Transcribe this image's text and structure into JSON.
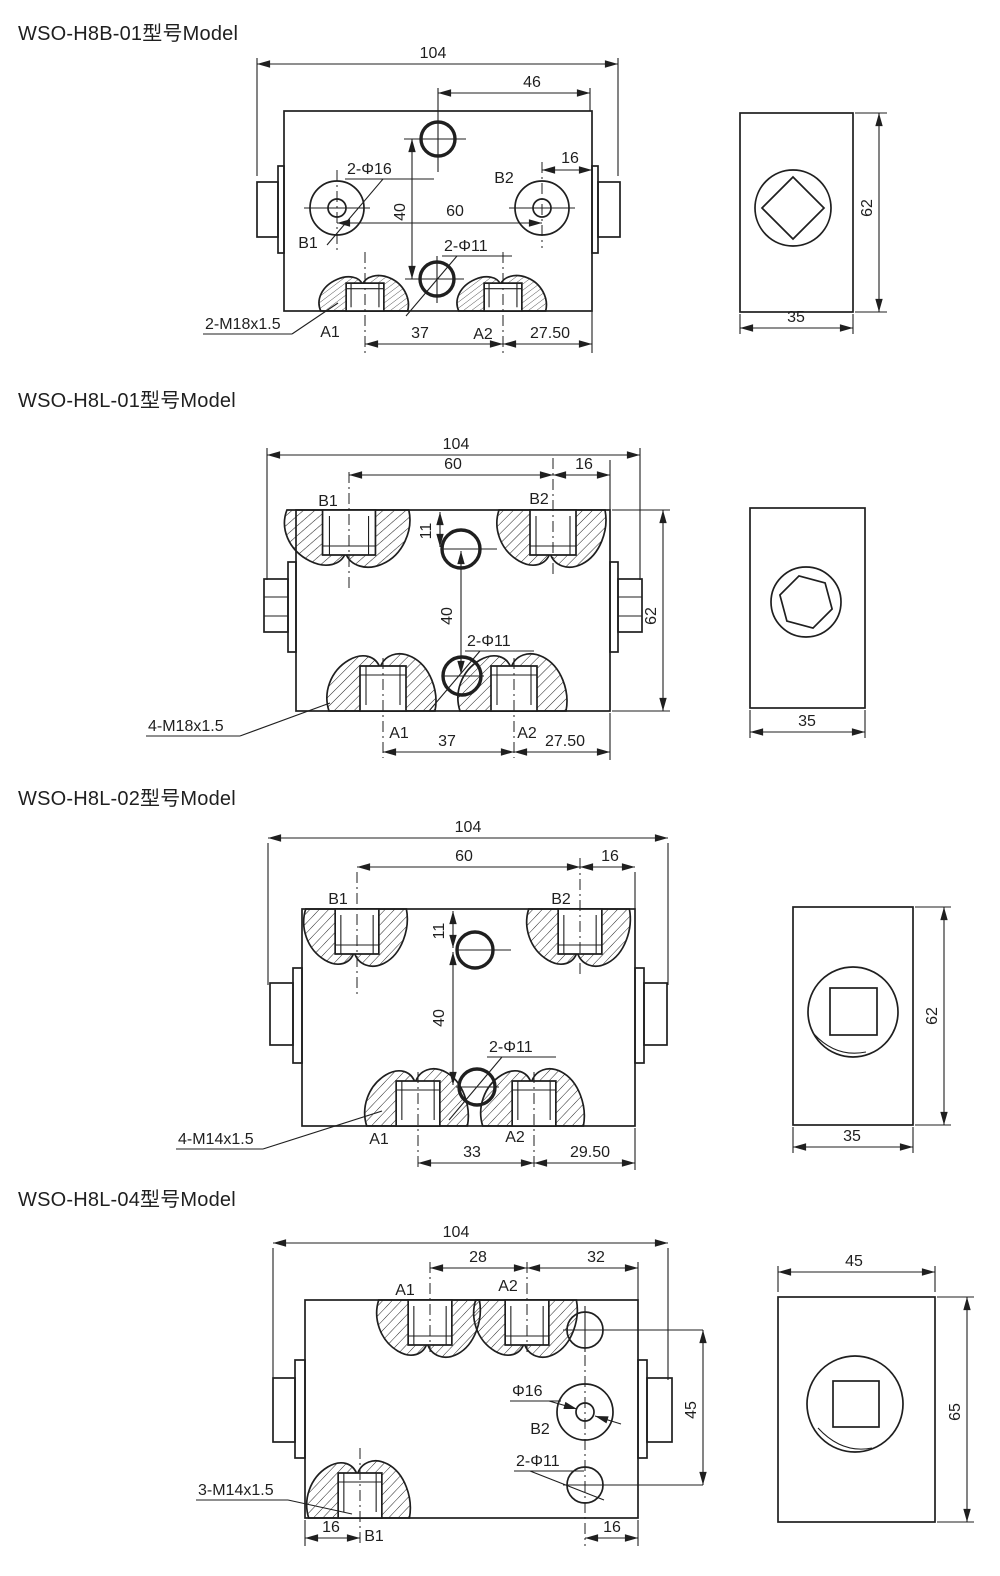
{
  "drawing": {
    "line_color": "#1f1f1f",
    "sections": [
      {
        "title": "WSO-H8B-01型号Model",
        "front": {
          "labels": {
            "b1": "B1",
            "b2": "B2",
            "a1": "A1",
            "a2": "A2"
          },
          "dims": {
            "overall_width": "104",
            "top_hole_from_edge": "46",
            "b2_to_edge": "16",
            "port_spacing": "60",
            "hole_vertical": "40",
            "a_spacing": "37",
            "a2_to_edge": "27.50"
          },
          "callouts": {
            "phi16": "2-Φ16",
            "phi11": "2-Φ11",
            "thread": "2-M18x1.5"
          }
        },
        "side": {
          "dims": {
            "height": "62",
            "depth": "35"
          }
        }
      },
      {
        "title": "WSO-H8L-01型号Model",
        "front": {
          "labels": {
            "b1": "B1",
            "b2": "B2",
            "a1": "A1",
            "a2": "A2"
          },
          "dims": {
            "overall_width": "104",
            "port_spacing": "60",
            "b2_to_edge": "16",
            "hole_offset": "11",
            "hole_vertical": "40",
            "height": "62",
            "a_spacing": "37",
            "a2_to_edge": "27.50"
          },
          "callouts": {
            "phi11": "2-Φ11",
            "thread": "4-M18x1.5"
          }
        },
        "side": {
          "dims": {
            "depth": "35"
          }
        }
      },
      {
        "title": "WSO-H8L-02型号Model",
        "front": {
          "labels": {
            "b1": "B1",
            "b2": "B2",
            "a1": "A1",
            "a2": "A2"
          },
          "dims": {
            "overall_width": "104",
            "port_spacing": "60",
            "b2_to_edge": "16",
            "hole_offset": "11",
            "hole_vertical": "40",
            "a_spacing": "33",
            "a2_to_edge": "29.50"
          },
          "callouts": {
            "phi11": "2-Φ11",
            "thread": "4-M14x1.5"
          }
        },
        "side": {
          "dims": {
            "height": "62",
            "depth": "35"
          }
        }
      },
      {
        "title": "WSO-H8L-04型号Model",
        "front": {
          "labels": {
            "a1": "A1",
            "a2": "A2",
            "b1": "B1",
            "b2": "B2"
          },
          "dims": {
            "overall_width": "104",
            "a_spacing": "28",
            "a2_to_edge": "32",
            "hole_span": "45",
            "b1_to_edge": "16",
            "b2_to_edge": "16"
          },
          "callouts": {
            "phi16": "Φ16",
            "phi11": "2-Φ11",
            "thread": "3-M14x1.5"
          }
        },
        "side": {
          "dims": {
            "width": "45",
            "height": "65"
          }
        }
      }
    ]
  }
}
